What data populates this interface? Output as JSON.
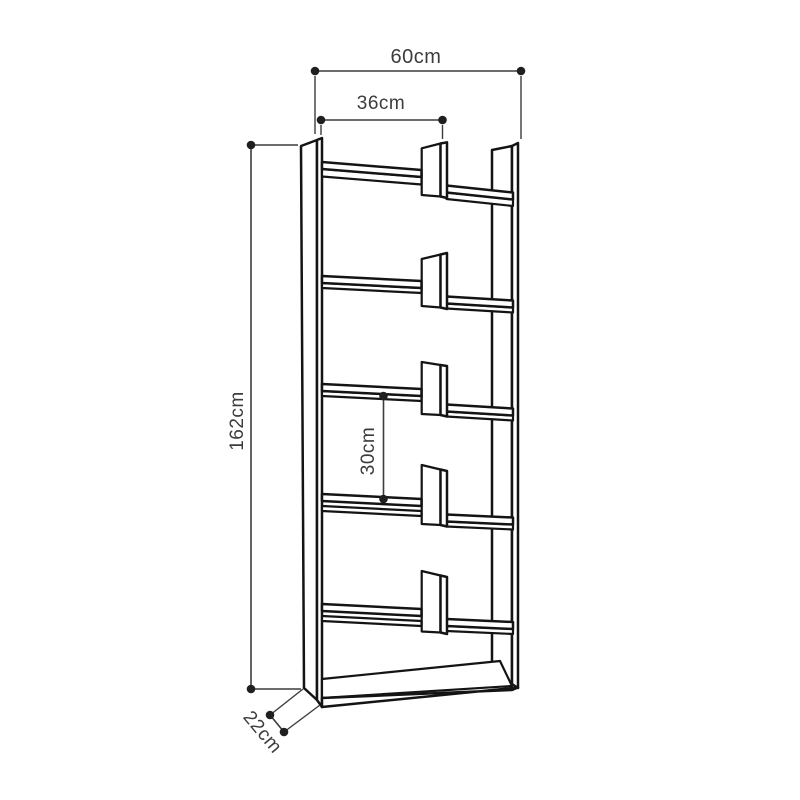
{
  "page": {
    "background": "#ffffff"
  },
  "diagram": {
    "subject": "bookcase-dimension-diagram",
    "dimensions": {
      "total_width": "60cm",
      "inner_width": "36cm",
      "total_height": "162cm",
      "shelf_spacing": "30cm",
      "depth": "22cm"
    },
    "colors": {
      "outline": "#141414",
      "dimension_line": "#3c3c3c",
      "dimension_text": "#3c3c3c",
      "fill": "#ffffff"
    }
  }
}
